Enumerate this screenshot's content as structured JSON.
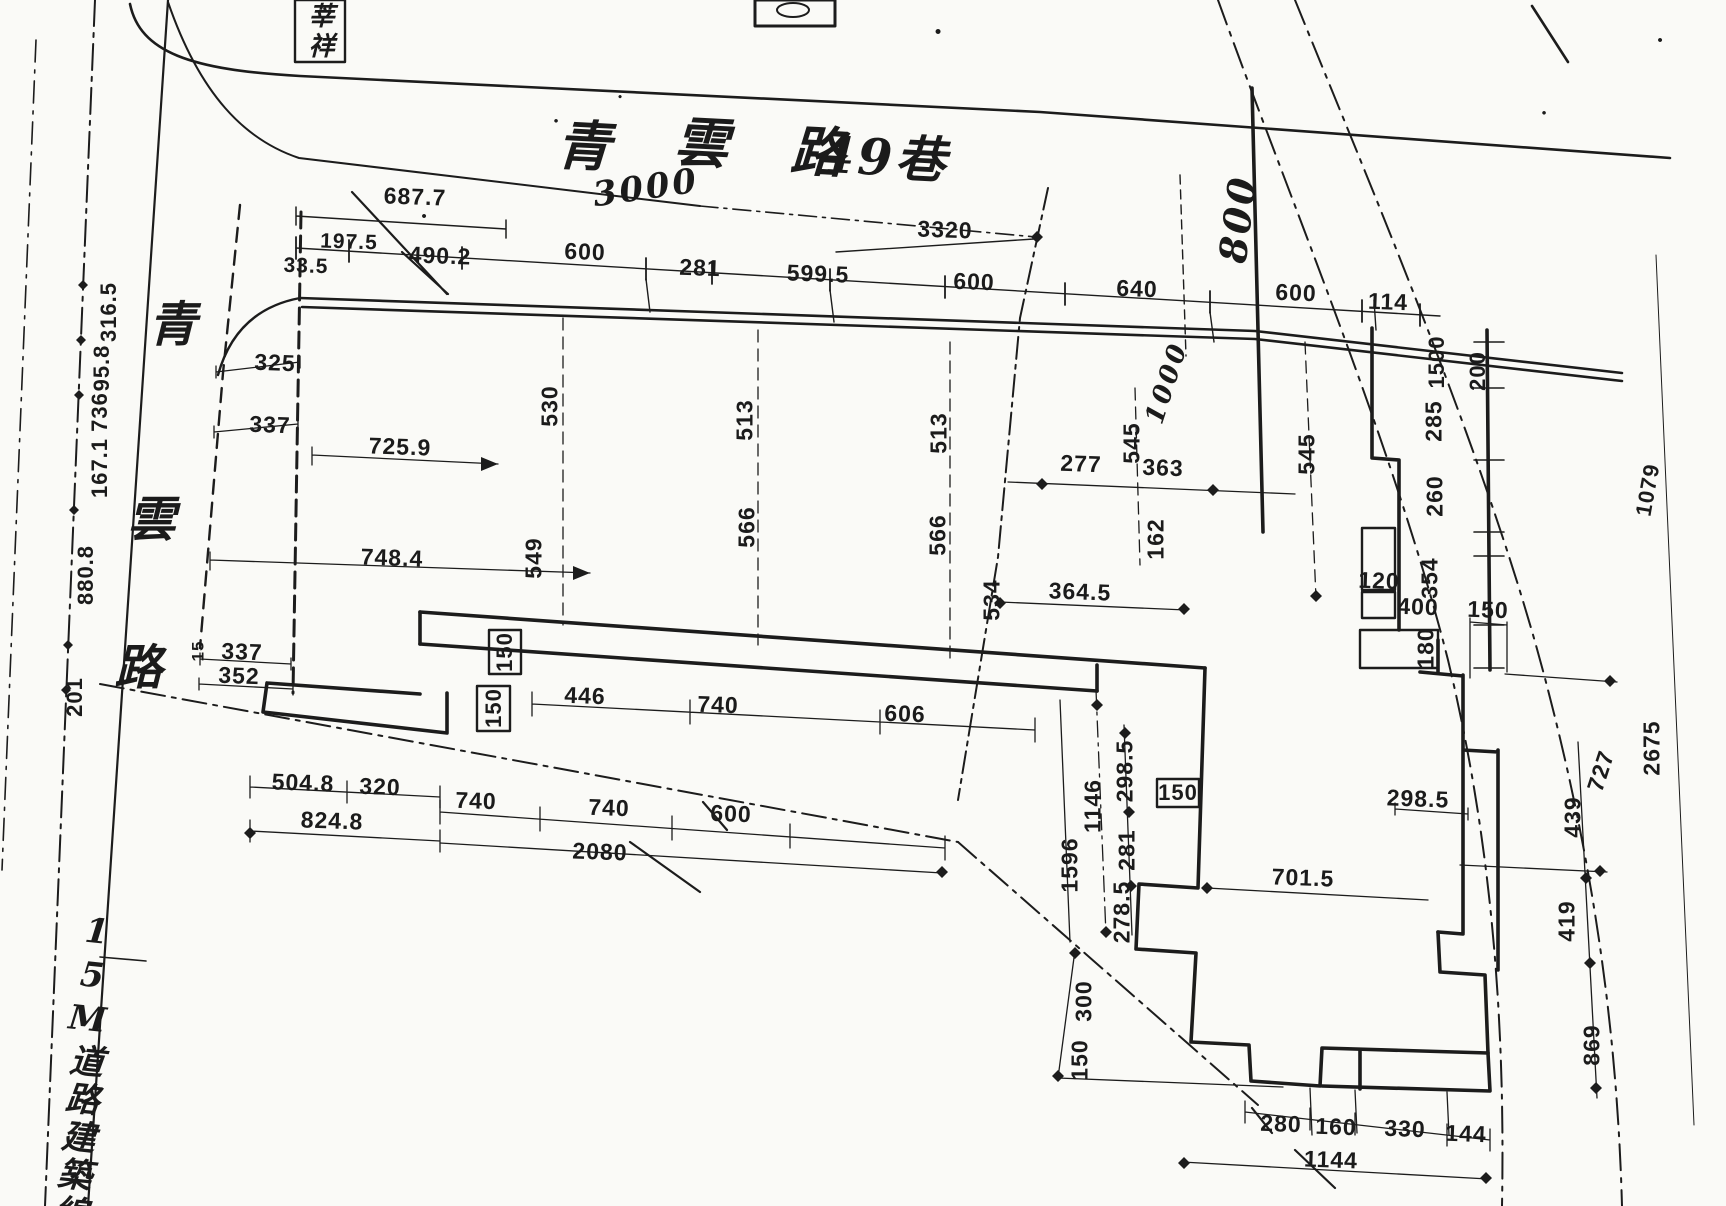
{
  "colors": {
    "ink": "#1c1c1c",
    "paper": "#fafaf7"
  },
  "drawing": {
    "top_road_name": "青雲路49巷",
    "left_road_name": "青雲路",
    "corner_box_text": "莘祥",
    "building_line_text": "15M道路建築線",
    "labels": [
      {
        "n": "lane-name-char-1",
        "t": "青",
        "x": 585,
        "y": 146,
        "r": 3,
        "s": 54,
        "c": "hand"
      },
      {
        "n": "lane-name-char-2",
        "t": "雲",
        "x": 703,
        "y": 143,
        "r": 3,
        "s": 54,
        "c": "hand"
      },
      {
        "n": "lane-name-char-3",
        "t": "路",
        "x": 819,
        "y": 152,
        "r": 3,
        "s": 54,
        "c": "hand"
      },
      {
        "n": "lane-name-char-4",
        "t": "49巷",
        "x": 884,
        "y": 158,
        "r": 3,
        "s": 50,
        "c": "hand"
      },
      {
        "n": "dim-3000",
        "t": "3000",
        "x": 646,
        "y": 188,
        "r": -8,
        "s": 34,
        "c": "hand"
      },
      {
        "n": "dim-800",
        "t": "800",
        "x": 1238,
        "y": 219,
        "r": -83,
        "s": 38,
        "c": "hand"
      },
      {
        "n": "dim-1000",
        "t": "1000",
        "x": 1167,
        "y": 383,
        "r": -72,
        "s": 26,
        "c": "hand"
      },
      {
        "n": "road-name-char-1",
        "t": "青",
        "x": 174,
        "y": 325,
        "r": 0,
        "s": 48,
        "c": "hand"
      },
      {
        "n": "road-name-char-2",
        "t": "雲",
        "x": 153,
        "y": 520,
        "r": 0,
        "s": 48,
        "c": "hand"
      },
      {
        "n": "road-name-char-3",
        "t": "路",
        "x": 140,
        "y": 668,
        "r": 0,
        "s": 48,
        "c": "hand"
      },
      {
        "n": "corner-box-text",
        "t": "莘祥",
        "x": 319,
        "y": 32,
        "r": 0,
        "s": 26,
        "c": "hand vbox"
      },
      {
        "n": "road-building-line-text",
        "t": "15M道路建築線",
        "x": 82,
        "y": 1072,
        "r": 6,
        "s": 34,
        "c": "hand vbox"
      },
      {
        "n": "dim-687-7",
        "t": "687.7",
        "x": 415,
        "y": 197,
        "r": 2,
        "s": 23
      },
      {
        "n": "dim-197-5",
        "t": "197.5",
        "x": 349,
        "y": 242,
        "r": 2,
        "s": 21
      },
      {
        "n": "dim-33-5",
        "t": "33.5",
        "x": 306,
        "y": 266,
        "r": 2,
        "s": 21
      },
      {
        "n": "dim-490-2",
        "t": "490.2",
        "x": 440,
        "y": 256,
        "r": 2,
        "s": 23
      },
      {
        "n": "dim-600-a",
        "t": "600",
        "x": 585,
        "y": 252,
        "r": 2,
        "s": 23
      },
      {
        "n": "dim-281-a",
        "t": "281",
        "x": 700,
        "y": 268,
        "r": 2,
        "s": 23
      },
      {
        "n": "dim-599-5",
        "t": "599.5",
        "x": 818,
        "y": 274,
        "r": 2,
        "s": 23
      },
      {
        "n": "dim-600-b",
        "t": "600",
        "x": 974,
        "y": 282,
        "r": 2,
        "s": 23
      },
      {
        "n": "dim-3320",
        "t": "3320",
        "x": 945,
        "y": 230,
        "r": 2,
        "s": 23
      },
      {
        "n": "dim-640",
        "t": "640",
        "x": 1137,
        "y": 289,
        "r": 2,
        "s": 23
      },
      {
        "n": "dim-600-c",
        "t": "600",
        "x": 1296,
        "y": 293,
        "r": 2,
        "s": 23
      },
      {
        "n": "dim-114",
        "t": "114",
        "x": 1388,
        "y": 302,
        "r": 2,
        "s": 23
      },
      {
        "n": "dim-1500",
        "t": "1500",
        "x": 1437,
        "y": 362,
        "r": -90,
        "s": 22
      },
      {
        "n": "dim-200",
        "t": "200",
        "x": 1478,
        "y": 371,
        "r": -90,
        "s": 22
      },
      {
        "n": "dim-285",
        "t": "285",
        "x": 1434,
        "y": 421,
        "r": -90,
        "s": 23
      },
      {
        "n": "dim-260",
        "t": "260",
        "x": 1435,
        "y": 496,
        "r": -90,
        "s": 23
      },
      {
        "n": "dim-354",
        "t": "354",
        "x": 1430,
        "y": 578,
        "r": -90,
        "s": 23
      },
      {
        "n": "dim-400",
        "t": "400",
        "x": 1418,
        "y": 607,
        "r": 2,
        "s": 23
      },
      {
        "n": "dim-120",
        "t": "120",
        "x": 1379,
        "y": 581,
        "r": 2,
        "s": 23
      },
      {
        "n": "dim-180",
        "t": "180",
        "x": 1426,
        "y": 648,
        "r": -90,
        "s": 23
      },
      {
        "n": "dim-150-e",
        "t": "150",
        "x": 1488,
        "y": 610,
        "r": 2,
        "s": 23
      },
      {
        "n": "dim-325",
        "t": "325",
        "x": 275,
        "y": 363,
        "r": 2,
        "s": 23
      },
      {
        "n": "dim-337-a",
        "t": "337",
        "x": 270,
        "y": 425,
        "r": 2,
        "s": 23
      },
      {
        "n": "dim-725-9",
        "t": "725.9",
        "x": 400,
        "y": 447,
        "r": 2,
        "s": 23
      },
      {
        "n": "dim-748-4",
        "t": "748.4",
        "x": 392,
        "y": 558,
        "r": 2,
        "s": 23
      },
      {
        "n": "dim-530",
        "t": "530",
        "x": 550,
        "y": 406,
        "r": -90,
        "s": 23
      },
      {
        "n": "dim-549",
        "t": "549",
        "x": 534,
        "y": 558,
        "r": -90,
        "s": 23
      },
      {
        "n": "dim-513-a",
        "t": "513",
        "x": 745,
        "y": 420,
        "r": -90,
        "s": 23
      },
      {
        "n": "dim-513-b",
        "t": "513",
        "x": 939,
        "y": 433,
        "r": -90,
        "s": 23
      },
      {
        "n": "dim-566-a",
        "t": "566",
        "x": 747,
        "y": 527,
        "r": -90,
        "s": 23
      },
      {
        "n": "dim-566-b",
        "t": "566",
        "x": 938,
        "y": 535,
        "r": -90,
        "s": 23
      },
      {
        "n": "dim-534",
        "t": "534",
        "x": 992,
        "y": 600,
        "r": -90,
        "s": 23
      },
      {
        "n": "dim-364-5",
        "t": "364.5",
        "x": 1080,
        "y": 592,
        "r": 2,
        "s": 23
      },
      {
        "n": "dim-277",
        "t": "277",
        "x": 1081,
        "y": 464,
        "r": 2,
        "s": 23
      },
      {
        "n": "dim-363",
        "t": "363",
        "x": 1163,
        "y": 468,
        "r": 2,
        "s": 23
      },
      {
        "n": "dim-545-a",
        "t": "545",
        "x": 1132,
        "y": 443,
        "r": -90,
        "s": 23
      },
      {
        "n": "dim-545-b",
        "t": "545",
        "x": 1307,
        "y": 454,
        "r": -90,
        "s": 23
      },
      {
        "n": "dim-162",
        "t": "162",
        "x": 1156,
        "y": 539,
        "r": -90,
        "s": 23
      },
      {
        "n": "dim-337-b",
        "t": "337",
        "x": 242,
        "y": 652,
        "r": 2,
        "s": 23
      },
      {
        "n": "dim-352",
        "t": "352",
        "x": 239,
        "y": 676,
        "r": 2,
        "s": 23
      },
      {
        "n": "dim-15",
        "t": "15",
        "x": 198,
        "y": 651,
        "r": -90,
        "s": 17
      },
      {
        "n": "dim-201",
        "t": "201",
        "x": 75,
        "y": 697,
        "r": -90,
        "s": 22
      },
      {
        "n": "dim-880-8",
        "t": "880.8",
        "x": 86,
        "y": 575,
        "r": -90,
        "s": 22
      },
      {
        "n": "dim-167-1",
        "t": "167.1",
        "x": 100,
        "y": 468,
        "r": -90,
        "s": 22
      },
      {
        "n": "dim-736",
        "t": "736",
        "x": 100,
        "y": 412,
        "r": -90,
        "s": 22
      },
      {
        "n": "dim-95-8",
        "t": "95.8",
        "x": 102,
        "y": 368,
        "r": -90,
        "s": 22
      },
      {
        "n": "dim-316-5",
        "t": "316.5",
        "x": 109,
        "y": 312,
        "r": -90,
        "s": 22
      },
      {
        "n": "dim-150-box-a",
        "t": "150",
        "x": 505,
        "y": 652,
        "r": -90,
        "s": 22
      },
      {
        "n": "dim-150-box-b",
        "t": "150",
        "x": 494,
        "y": 708,
        "r": -90,
        "s": 22
      },
      {
        "n": "dim-446",
        "t": "446",
        "x": 585,
        "y": 696,
        "r": 2,
        "s": 23
      },
      {
        "n": "dim-740-a",
        "t": "740",
        "x": 718,
        "y": 705,
        "r": 2,
        "s": 23
      },
      {
        "n": "dim-606",
        "t": "606",
        "x": 905,
        "y": 714,
        "r": 2,
        "s": 23
      },
      {
        "n": "dim-504-8",
        "t": "504.8",
        "x": 303,
        "y": 783,
        "r": 2,
        "s": 23
      },
      {
        "n": "dim-320",
        "t": "320",
        "x": 380,
        "y": 787,
        "r": 2,
        "s": 23
      },
      {
        "n": "dim-740-b",
        "t": "740",
        "x": 476,
        "y": 801,
        "r": 2,
        "s": 23
      },
      {
        "n": "dim-740-c",
        "t": "740",
        "x": 609,
        "y": 808,
        "r": 2,
        "s": 23
      },
      {
        "n": "dim-600-d",
        "t": "600",
        "x": 731,
        "y": 814,
        "r": 2,
        "s": 23
      },
      {
        "n": "dim-824-8",
        "t": "824.8",
        "x": 332,
        "y": 821,
        "r": 2,
        "s": 23
      },
      {
        "n": "dim-2080",
        "t": "2080",
        "x": 600,
        "y": 852,
        "r": 2,
        "s": 23
      },
      {
        "n": "dim-1146",
        "t": "1146",
        "x": 1093,
        "y": 806,
        "r": -90,
        "s": 23
      },
      {
        "n": "dim-1596",
        "t": "1596",
        "x": 1070,
        "y": 865,
        "r": -90,
        "s": 23
      },
      {
        "n": "dim-298-5-a",
        "t": "298.5",
        "x": 1125,
        "y": 771,
        "r": -90,
        "s": 23
      },
      {
        "n": "dim-281-b",
        "t": "281",
        "x": 1127,
        "y": 850,
        "r": -90,
        "s": 23
      },
      {
        "n": "dim-278-5",
        "t": "278.5",
        "x": 1122,
        "y": 912,
        "r": -90,
        "s": 23
      },
      {
        "n": "dim-150-box-c",
        "t": "150",
        "x": 1178,
        "y": 793,
        "r": 0,
        "s": 22
      },
      {
        "n": "dim-701-5",
        "t": "701.5",
        "x": 1303,
        "y": 878,
        "r": 2,
        "s": 23
      },
      {
        "n": "dim-298-5-b",
        "t": "298.5",
        "x": 1418,
        "y": 799,
        "r": 2,
        "s": 23
      },
      {
        "n": "dim-300",
        "t": "300",
        "x": 1084,
        "y": 1001,
        "r": -90,
        "s": 23
      },
      {
        "n": "dim-150-d",
        "t": "150",
        "x": 1080,
        "y": 1060,
        "r": -90,
        "s": 23
      },
      {
        "n": "dim-727",
        "t": "727",
        "x": 1601,
        "y": 771,
        "r": -72,
        "s": 23
      },
      {
        "n": "dim-2675",
        "t": "2675",
        "x": 1652,
        "y": 748,
        "r": -90,
        "s": 23
      },
      {
        "n": "dim-1079",
        "t": "1079",
        "x": 1648,
        "y": 490,
        "r": -80,
        "s": 22
      },
      {
        "n": "dim-439",
        "t": "439",
        "x": 1573,
        "y": 817,
        "r": -90,
        "s": 23
      },
      {
        "n": "dim-419",
        "t": "419",
        "x": 1567,
        "y": 921,
        "r": -90,
        "s": 23
      },
      {
        "n": "dim-869",
        "t": "869",
        "x": 1592,
        "y": 1045,
        "r": -90,
        "s": 23
      },
      {
        "n": "dim-280",
        "t": "280",
        "x": 1281,
        "y": 1124,
        "r": 2,
        "s": 23
      },
      {
        "n": "dim-160",
        "t": "160",
        "x": 1336,
        "y": 1127,
        "r": 2,
        "s": 23
      },
      {
        "n": "dim-330",
        "t": "330",
        "x": 1405,
        "y": 1129,
        "r": 2,
        "s": 23
      },
      {
        "n": "dim-144",
        "t": "144",
        "x": 1466,
        "y": 1134,
        "r": 2,
        "s": 23
      },
      {
        "n": "dim-1144",
        "t": "1144",
        "x": 1331,
        "y": 1160,
        "r": 2,
        "s": 23
      }
    ]
  }
}
